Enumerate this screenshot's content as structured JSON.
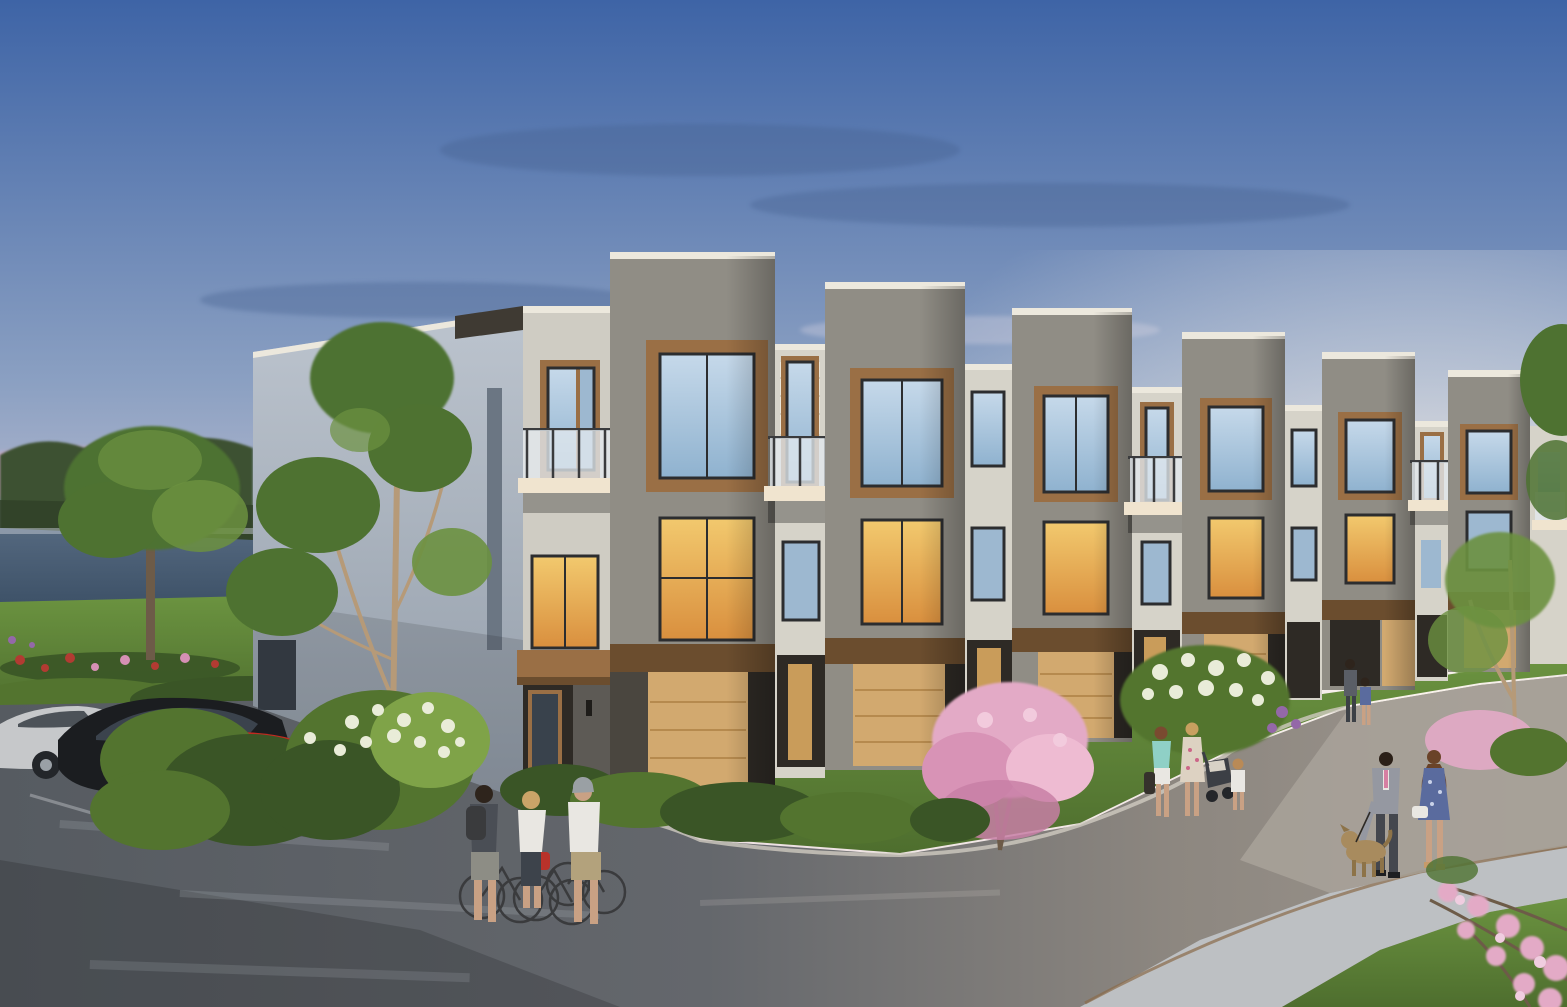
{
  "scene": {
    "type": "architectural-rendering",
    "title": "Modern Townhome Community at Dusk",
    "description": "Photorealistic rendering of a row of modern three-storey townhomes at dusk. Grey brick tower volumes with stepped parapets alternate with cream recessed bays, wood-toned window surrounds, glass-railing balconies and tan garage doors. A blue-to-pink sunset sky sits over a pond and tree line at left. Cars are parked at the left (silver, black and red), three cyclists chat in the foreground street, a family with a stroller and a couple walking a small dog stroll along the curving drive, and flowering pink and lilac shrubs dot the landscaped lawns.",
    "time_of_day": "dusk",
    "setting": "suburban courtyard street with pond, lawns and flowering landscaping"
  },
  "palette": {
    "sky_top": "#3e64a6",
    "sky_mid": "#8ba0c2",
    "sky_low": "#cfc9d6",
    "sky_pink": "#eadde0",
    "sky_glow": "#fdf5ef",
    "cloud": "#44608f",
    "treeline": "#3d5133",
    "lake_top": "#54687f",
    "lake_bottom": "#3c5066",
    "lawn_light": "#6b9340",
    "lawn_dark": "#4e6e2e",
    "bush_dark": "#3a5526",
    "bush_mid": "#53742f",
    "bush_light": "#7fa348",
    "flower_red": "#b23b32",
    "flower_pink": "#d690b4",
    "flower_purple": "#9468a8",
    "blossom_white": "#e9ecd8",
    "blossom_pink": "#e3aac6",
    "tree_green": "#4e7231",
    "tree_green_light": "#6c9140",
    "trunk": "#b69a78",
    "trunk_dark": "#6d5b48",
    "brick_dark": "#908d85",
    "brick_cream": "#d6d3c9",
    "brick_corner": "#cfccc3",
    "sidewall_top": "#bcc4ce",
    "sidewall_bottom": "#929ca8",
    "parapet": "#ece8dd",
    "wood": "#9a6f45",
    "wood_dark": "#6b4d2e",
    "frame": "#2c2d2f",
    "glass_sky2": "#9db8d0",
    "glass_dark": "#39424c",
    "glass_warm_hi": "#f2c96e",
    "glass_warm_lo": "#d98f3e",
    "balcony_slab": "#f0e4cf",
    "balcony_glass": "#e3e9ee",
    "rail": "#3a3b3d",
    "garage": "#d2a96f",
    "garage_dark": "#b68a4e",
    "recess": "#2e2a25",
    "step": "#cfc7b8",
    "road_dark": "#565b61",
    "road_warm": "#8d8780",
    "road_light": "#9d968e",
    "sidewalk": "#bdc0c3",
    "curb_brown": "#8a6b4a",
    "car_silver": "#c6c8ca",
    "car_black": "#1b1d20",
    "car_red": "#c22a20",
    "skin": "#c9a184",
    "shirt_white": "#e9e7e2",
    "teal_top": "#8fd0c6",
    "khaki": "#b3a27c",
    "suit_grey": "#9598a1",
    "tie_pink": "#d67fa2",
    "dress_blue": "#5a6b9e",
    "dog_tan": "#a88b5e"
  },
  "objects": {
    "building": {
      "storeys": 3,
      "tower_bays_visible": 6,
      "materials": [
        "dark grey brick towers",
        "cream brick recessed bays",
        "light grey-blue brick end wall",
        "wood window surrounds",
        "white parapet caps"
      ],
      "features": [
        "glass-railing balconies",
        "tan panelled garage doors",
        "recessed entries with wood doors",
        "warm-lit interior windows",
        "entry canopy",
        "concrete steps",
        "narrow slot window on end wall"
      ]
    },
    "vehicles": [
      {
        "name": "silver-sedan",
        "color_key": "car_silver"
      },
      {
        "name": "black-sedan",
        "color_key": "car_black"
      },
      {
        "name": "red-compact-behind-shrubs",
        "color_key": "car_red"
      }
    ],
    "people": [
      {
        "group": "three-cyclists-chatting",
        "details": "backpacker in grey shorts, rider in white tee with red pannier, man in cap with khaki shorts"
      },
      {
        "group": "family-with-stroller",
        "details": "woman in teal top, woman in floral dress pushing stroller, toddler in white"
      },
      {
        "group": "couple-walking-dog",
        "details": "man in grey suit with pink tie, woman in blue dress, small tan dog on leash"
      },
      {
        "group": "residents-at-far-entry",
        "details": "adult and child in blue near doorway"
      }
    ],
    "vegetation": [
      "background tree line",
      "large green tree by pond",
      "red and pink flower bed",
      "multi-stem birch against end wall",
      "white lilac shrubs",
      "pink flowering tree",
      "low hedges",
      "overhanging pink blossom branches (foreground right)",
      "young tree at right"
    ],
    "water": "pond at left reflecting dusk sky",
    "hardscape": [
      "dark wet asphalt drive (left)",
      "warm asphalt lane (right)",
      "curved concrete sidewalk",
      "curbs",
      "entry walks"
    ]
  }
}
